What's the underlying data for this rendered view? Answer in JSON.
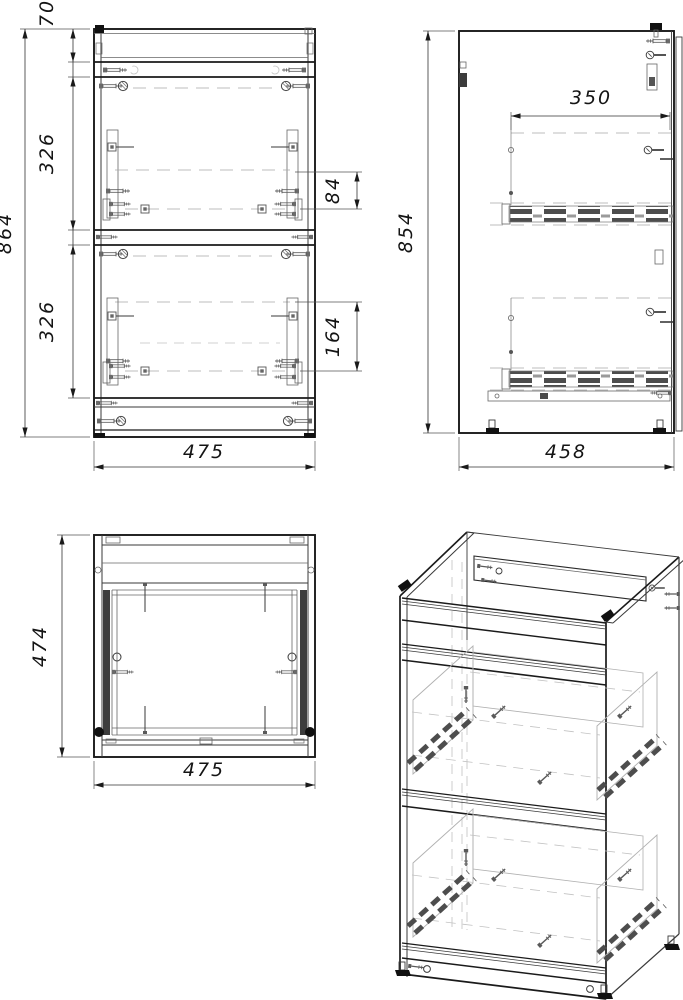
{
  "drawing_type": "cabinet-assembly-orthographic-views",
  "colors": {
    "line": "#1a1a1a",
    "hidden_line": "#a8a8a8",
    "hardware": "#4d4d4d",
    "background": "#ffffff"
  },
  "dims": {
    "front_top_rail_height": "70",
    "front_drawer1_height": "326",
    "front_drawer2_height": "326",
    "front_overall_height": "864",
    "front_slide1_offset": "84",
    "front_slide2_offset": "164",
    "front_width": "475",
    "side_slide_length": "350",
    "side_height": "854",
    "side_depth": "458",
    "top_depth": "474",
    "top_width": "475"
  }
}
